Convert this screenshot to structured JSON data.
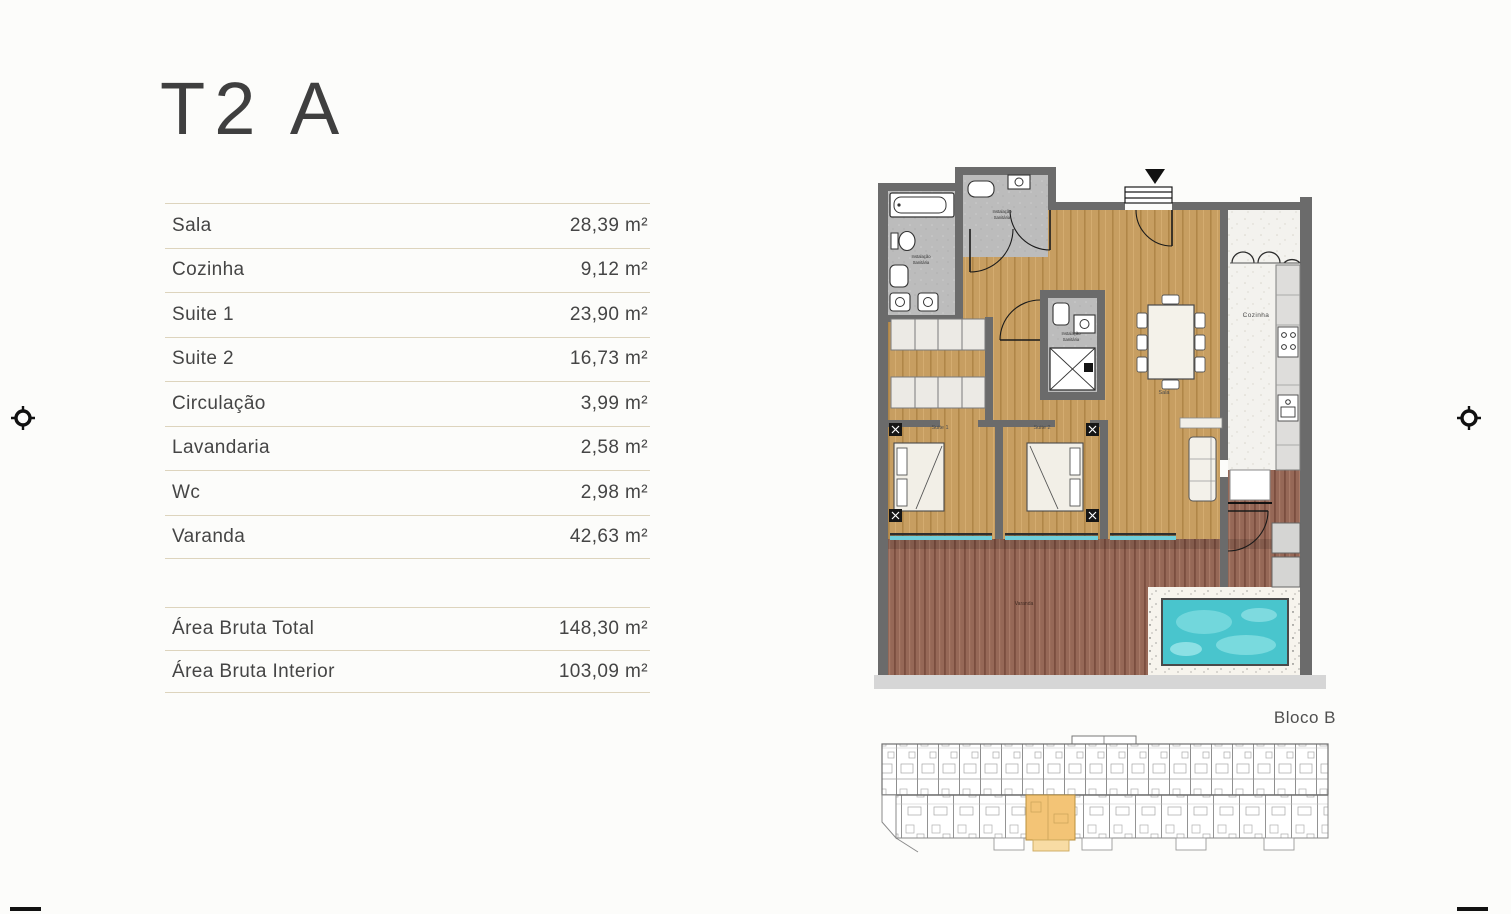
{
  "page": {
    "title": "T2 A",
    "bloco_label": "Bloco B"
  },
  "area_table": {
    "rows": [
      {
        "label": "Sala",
        "value": "28,39 m²"
      },
      {
        "label": "Cozinha",
        "value": "9,12 m²"
      },
      {
        "label": "Suite 1",
        "value": "23,90 m²"
      },
      {
        "label": "Suite 2",
        "value": "16,73 m²"
      },
      {
        "label": "Circulação",
        "value": "3,99 m²"
      },
      {
        "label": "Lavandaria",
        "value": "2,58 m²"
      },
      {
        "label": "Wc",
        "value": "2,98 m²"
      },
      {
        "label": "Varanda",
        "value": "42,63 m²"
      }
    ],
    "totals": [
      {
        "label": "Área Bruta Total",
        "value": "148,30 m²"
      },
      {
        "label": "Área Bruta Interior",
        "value": "103,09 m²"
      }
    ]
  },
  "floorplan": {
    "room_labels": {
      "kitchen": "Cozinha",
      "suite1": "Suite 1",
      "suite2": "Suite 2",
      "living": "Sala",
      "balcony": "Varanda",
      "bathroom_line1": "Instalação",
      "bathroom_line2": "Sanitária"
    },
    "colors": {
      "wall": "#6b6b6b",
      "wood_floor": "#c79e61",
      "deck": "#966857",
      "tile": "#bcbcbc",
      "pool": "#49c5cd",
      "unit_highlight": "#f3c476"
    }
  }
}
